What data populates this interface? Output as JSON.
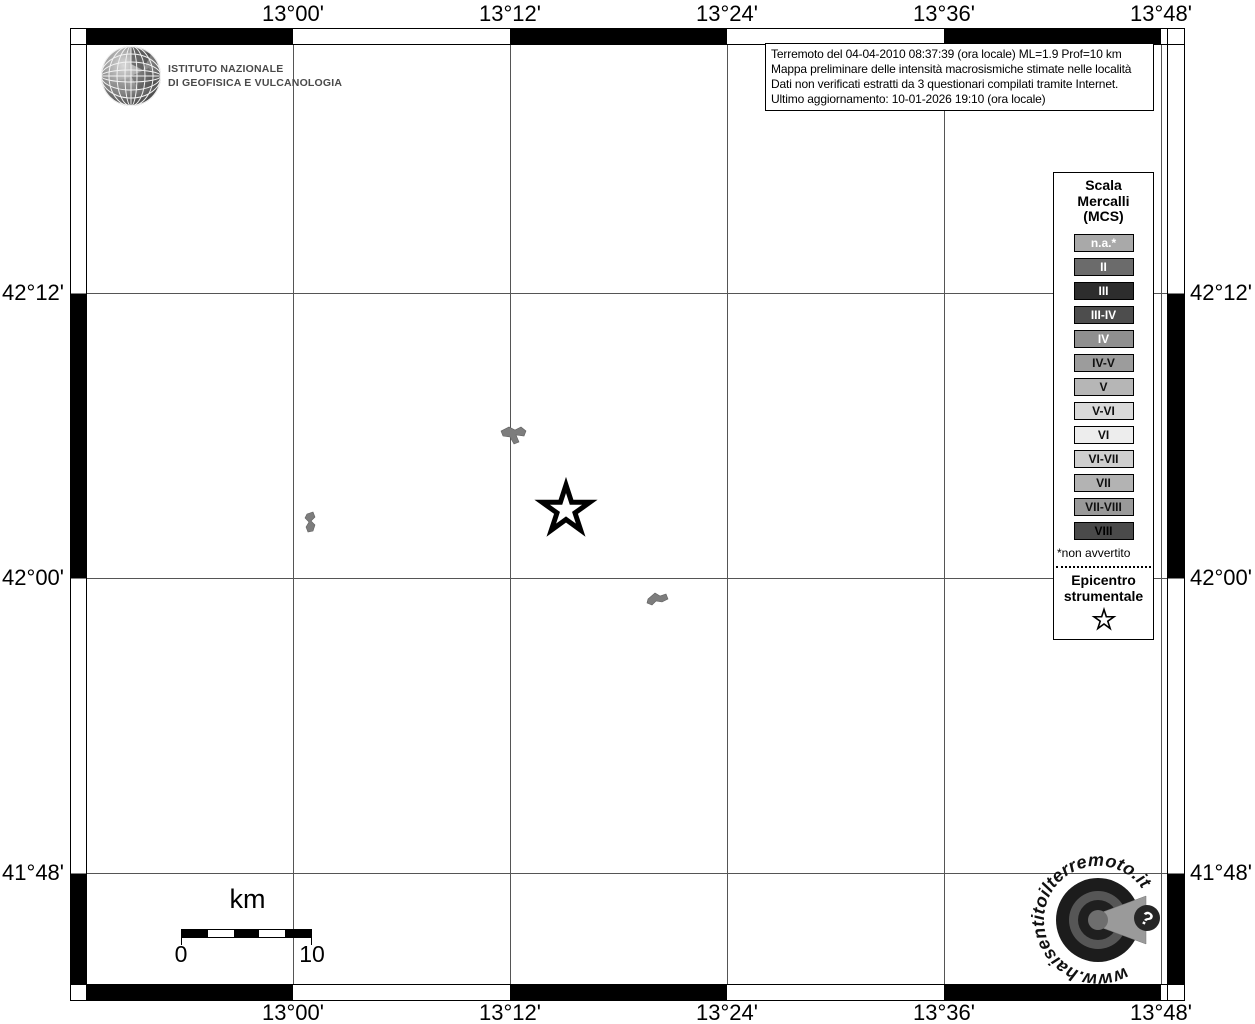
{
  "branding": {
    "institute_line1": "ISTITUTO NAZIONALE",
    "institute_line2": "DI GEOFISICA E VULCANOLOGIA"
  },
  "info_box": {
    "lines": [
      "Terremoto del 04-04-2010 08:37:39 (ora locale) ML=1.9 Prof=10 km",
      "Mappa preliminare delle intensità macrosismiche stimate nelle località",
      "Dati non verificati estratti da 3 questionari compilati tramite Internet.",
      "Ultimo aggiornamento: 10-01-2026 19:10 (ora locale)"
    ]
  },
  "axes": {
    "top": [
      "13°00'",
      "13°12'",
      "13°24'",
      "13°36'",
      "13°48'"
    ],
    "bottom": [
      "13°00'",
      "13°12'",
      "13°24'",
      "13°36'",
      "13°48'"
    ],
    "left": [
      "42°12'",
      "42°00'",
      "41°48'"
    ],
    "right": [
      "42°12'",
      "42°00'",
      "41°48'"
    ]
  },
  "legend": {
    "title_lines": [
      "Scala",
      "Mercalli",
      "(MCS)"
    ],
    "items": [
      {
        "label": "n.a.*",
        "bg": "#a9a9a9",
        "fg": "#ffffff"
      },
      {
        "label": "II",
        "bg": "#6b6b6b",
        "fg": "#ffffff"
      },
      {
        "label": "III",
        "bg": "#2d2d2d",
        "fg": "#ffffff"
      },
      {
        "label": "III-IV",
        "bg": "#4d4d4d",
        "fg": "#ffffff"
      },
      {
        "label": "IV",
        "bg": "#8f8f8f",
        "fg": "#ffffff"
      },
      {
        "label": "IV-V",
        "bg": "#9c9c9c",
        "fg": "#111111"
      },
      {
        "label": "V",
        "bg": "#b6b6b6",
        "fg": "#111111"
      },
      {
        "label": "V-VI",
        "bg": "#dadada",
        "fg": "#111111"
      },
      {
        "label": "VI",
        "bg": "#ededed",
        "fg": "#111111"
      },
      {
        "label": "VI-VII",
        "bg": "#cfcfcf",
        "fg": "#111111"
      },
      {
        "label": "VII",
        "bg": "#b3b3b3",
        "fg": "#111111"
      },
      {
        "label": "VII-VIII",
        "bg": "#999999",
        "fg": "#111111"
      },
      {
        "label": "VIII",
        "bg": "#4a4a4a",
        "fg": "#000000"
      }
    ],
    "footnote": "*non avvertito",
    "epicenter_line1": "Epicentro",
    "epicenter_line2": "strumentale"
  },
  "scale_bar": {
    "unit": "km",
    "start_label": "0",
    "end_label": "10"
  },
  "watermark": {
    "url_text": "www.haisentitoilterremoto.it",
    "question_mark": "?"
  },
  "map_features": {
    "epicenter_symbol": "star",
    "locality_count": 3,
    "locality_color": "#7d7d7d"
  }
}
